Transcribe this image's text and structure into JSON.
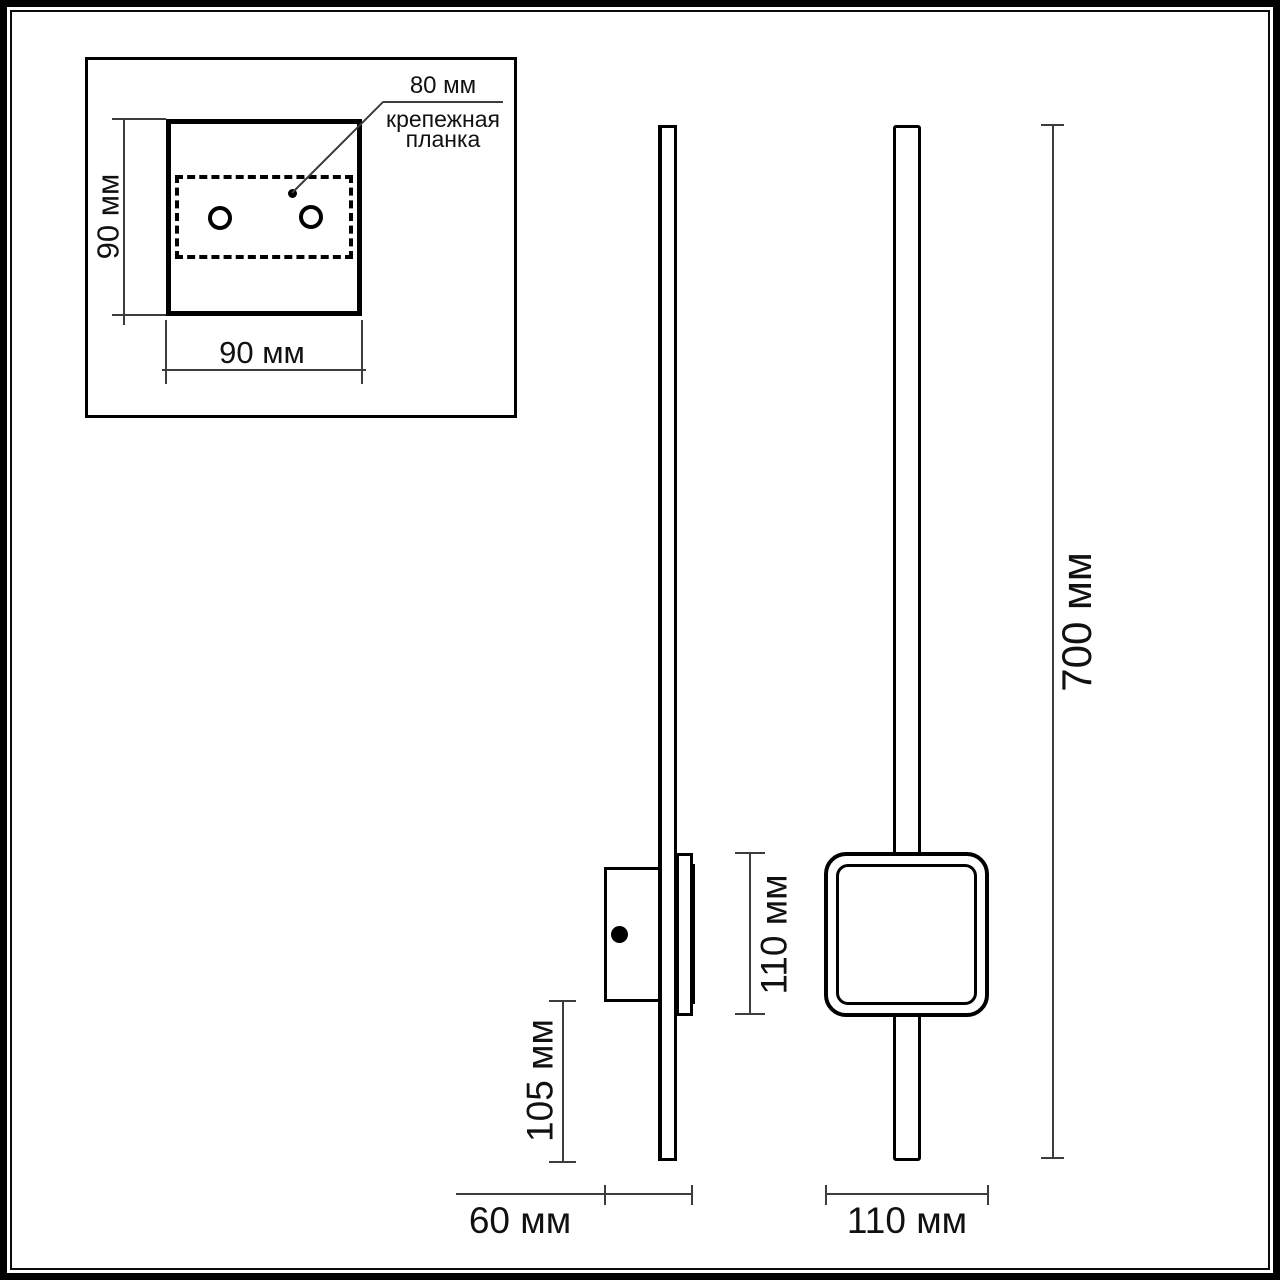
{
  "colors": {
    "background": "#ffffff",
    "object_line": "#000000",
    "dimension_line": "#3c3c3c",
    "text": "#111111"
  },
  "inset": {
    "plate_width_label": "80 мм",
    "plate_name_line1": "крепежная",
    "plate_name_line2": "планка",
    "height_label": "90 мм",
    "width_label": "90 мм"
  },
  "side_view": {
    "depth_label": "60 мм",
    "lower_overhang_label": "105 мм"
  },
  "front_view": {
    "frame_height_label": "110 мм",
    "frame_width_label": "110 мм",
    "total_height_label": "700 мм"
  }
}
